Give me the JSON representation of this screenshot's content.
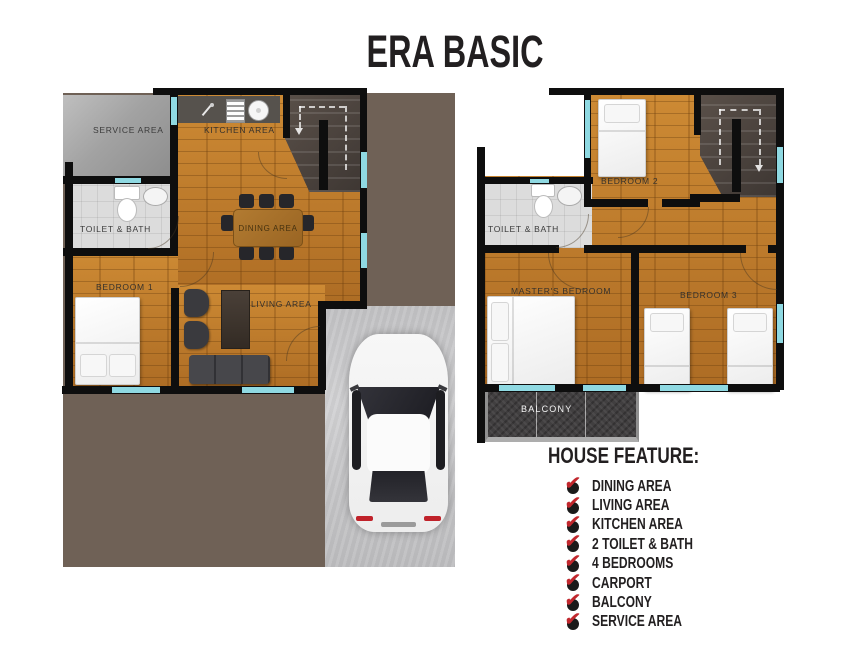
{
  "title": "ERA BASIC",
  "ground_floor": {
    "labels": {
      "service": "SERVICE AREA",
      "kitchen": "KITCHEN AREA",
      "toilet": "TOILET & BATH",
      "dining": "DINING AREA",
      "bedroom1": "BEDROOM 1",
      "living": "LIVING AREA"
    }
  },
  "second_floor": {
    "labels": {
      "bedroom2": "BEDROOM 2",
      "toilet": "TOILET & BATH",
      "master": "MASTER'S BEDROOM",
      "bedroom3": "BEDROOM 3",
      "balcony": "BALCONY"
    }
  },
  "features": {
    "title": "HOUSE FEATURE:",
    "items": [
      "DINING AREA",
      "LIVING AREA",
      "KITCHEN AREA",
      "2 TOILET & BATH",
      "4 BEDROOMS",
      "CARPORT",
      "BALCONY",
      "SERVICE AREA"
    ]
  },
  "colors": {
    "wood_floor": "#bf7d2e",
    "lot_brown": "#6f6156",
    "carport_gray": "#c7c7c9",
    "balcony_gray": "#413f40",
    "window_cyan": "#8fd9e2",
    "wall_black": "#0e0e0e",
    "check_red": "#c1272d",
    "title_black": "#221f20"
  }
}
